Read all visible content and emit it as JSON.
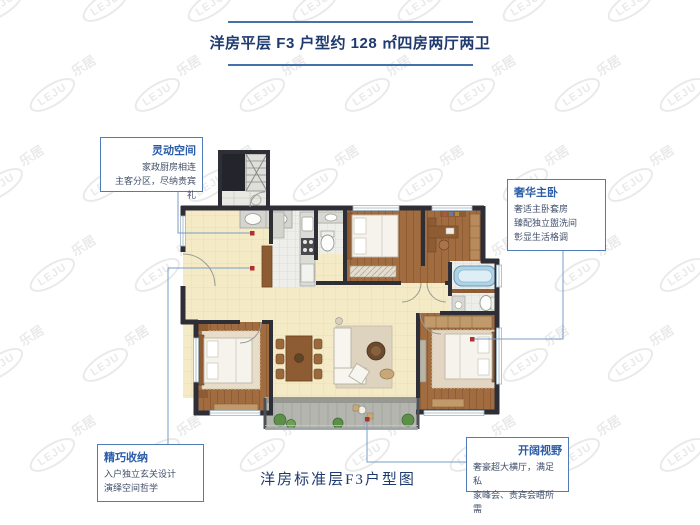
{
  "header": {
    "title": "洋房平层 F3 户型约 128 ㎡四房两厅两卫"
  },
  "caption": "洋房标准层F3户型图",
  "watermark": {
    "logo": "LEJU",
    "text": "乐居"
  },
  "callouts": {
    "flexible": {
      "title": "灵动空间",
      "lines": [
        "家政厨房相连",
        "主客分区，尽纳贵宾礼"
      ]
    },
    "master": {
      "title": "奢华主卧",
      "lines": [
        "奢适主卧套房",
        "臻配独立盥洗间",
        "彰显生活格调"
      ]
    },
    "storage": {
      "title": "精巧收纳",
      "lines": [
        "入户独立玄关设计",
        "演绎空间哲学"
      ]
    },
    "view": {
      "title": "开阔视野",
      "lines": [
        "奢豪超大横厅，满足私",
        "家峰会、贵宾会晤所需"
      ]
    }
  },
  "colors": {
    "accent_blue": "#4472a8",
    "title_text": "#1e3a6e",
    "callout_border": "#4f7cb8",
    "callout_title": "#2a5ca8",
    "connector_line": "#7a9cc6",
    "marker_dot": "#b03030",
    "wall": "#2e2e37",
    "wood_floor": "#a26c41",
    "cream_floor": "#f4ebc6",
    "tile_floor": "#ededE9",
    "balcony_floor": "#b3b5ae",
    "bathtub": "#aed2e6"
  }
}
